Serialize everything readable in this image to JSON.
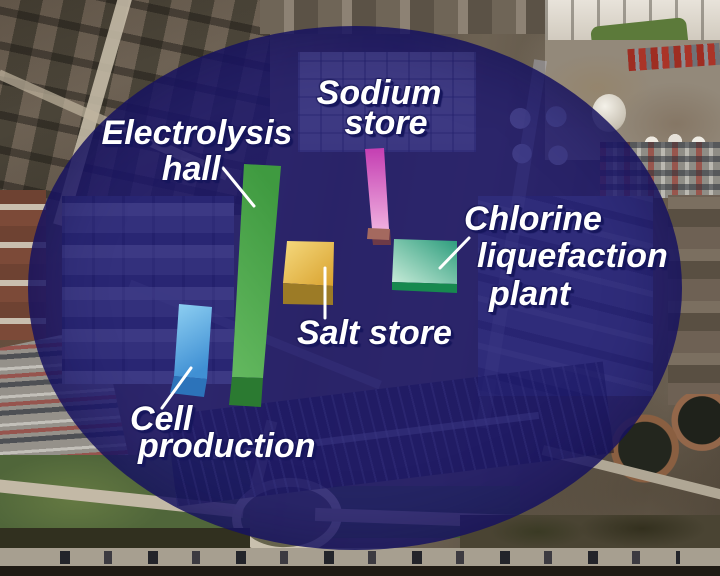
{
  "css_vars": {
    "overlay-fill": "rgba(28,22,112,0.80)",
    "label-color": "#ffffff",
    "label-shadow": "#16165c",
    "leader-color": "#ffffff"
  },
  "labels": {
    "electrolysis": {
      "lines": [
        "Electrolysis",
        "hall"
      ]
    },
    "sodium": {
      "lines": [
        "Sodium",
        "store"
      ]
    },
    "chlorine": {
      "lines": [
        "Chlorine",
        "liquefaction",
        "plant"
      ]
    },
    "salt": {
      "lines": [
        "Salt store"
      ]
    },
    "cell": {
      "lines": [
        "Cell",
        "production"
      ]
    }
  },
  "blocks": {
    "electrolysis": {
      "face_light": "#62b75e",
      "face_dark": "#3f9a40",
      "side": "#2b7a31"
    },
    "sodium": {
      "face_light": "#efaede",
      "face_dark": "#c43eb2",
      "side": "#6d3a47"
    },
    "salt": {
      "face_light": "#f5d97e",
      "face_dark": "#d9a22e",
      "side": "#9c7b26"
    },
    "chlorine": {
      "face_light": "#c9ecd9",
      "face_dark": "#2b9c7c",
      "side": "#17894f"
    },
    "cell": {
      "face_light": "#8fd0f2",
      "face_dark": "#4090d4",
      "side": "#2c73ba"
    }
  }
}
